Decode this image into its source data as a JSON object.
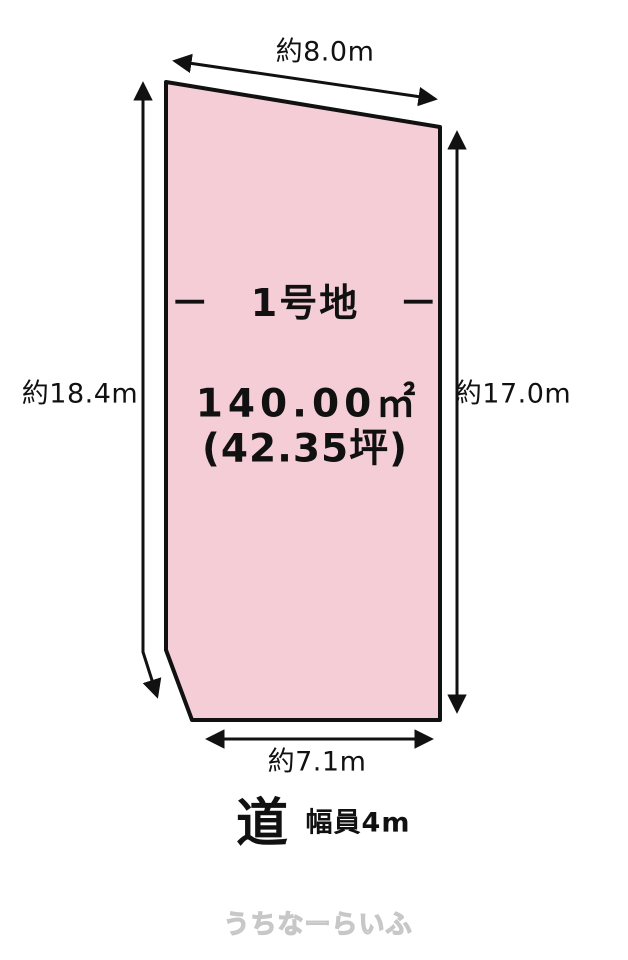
{
  "colors": {
    "plot_fill": "#f5cdd7",
    "line": "#111111",
    "watermark_outline": "#c7c7c7"
  },
  "dimensions": {
    "top": "約8.0m",
    "left": "約18.4m",
    "right": "約17.0m",
    "bottom": "約7.1m"
  },
  "plot": {
    "title": "－　1号地　－",
    "area_m2": "140.00㎡",
    "area_tsubo": "(42.35坪)"
  },
  "road": {
    "label": "道",
    "width_label": "幅員4m"
  },
  "watermark": {
    "text": "うちなーらいふ"
  }
}
